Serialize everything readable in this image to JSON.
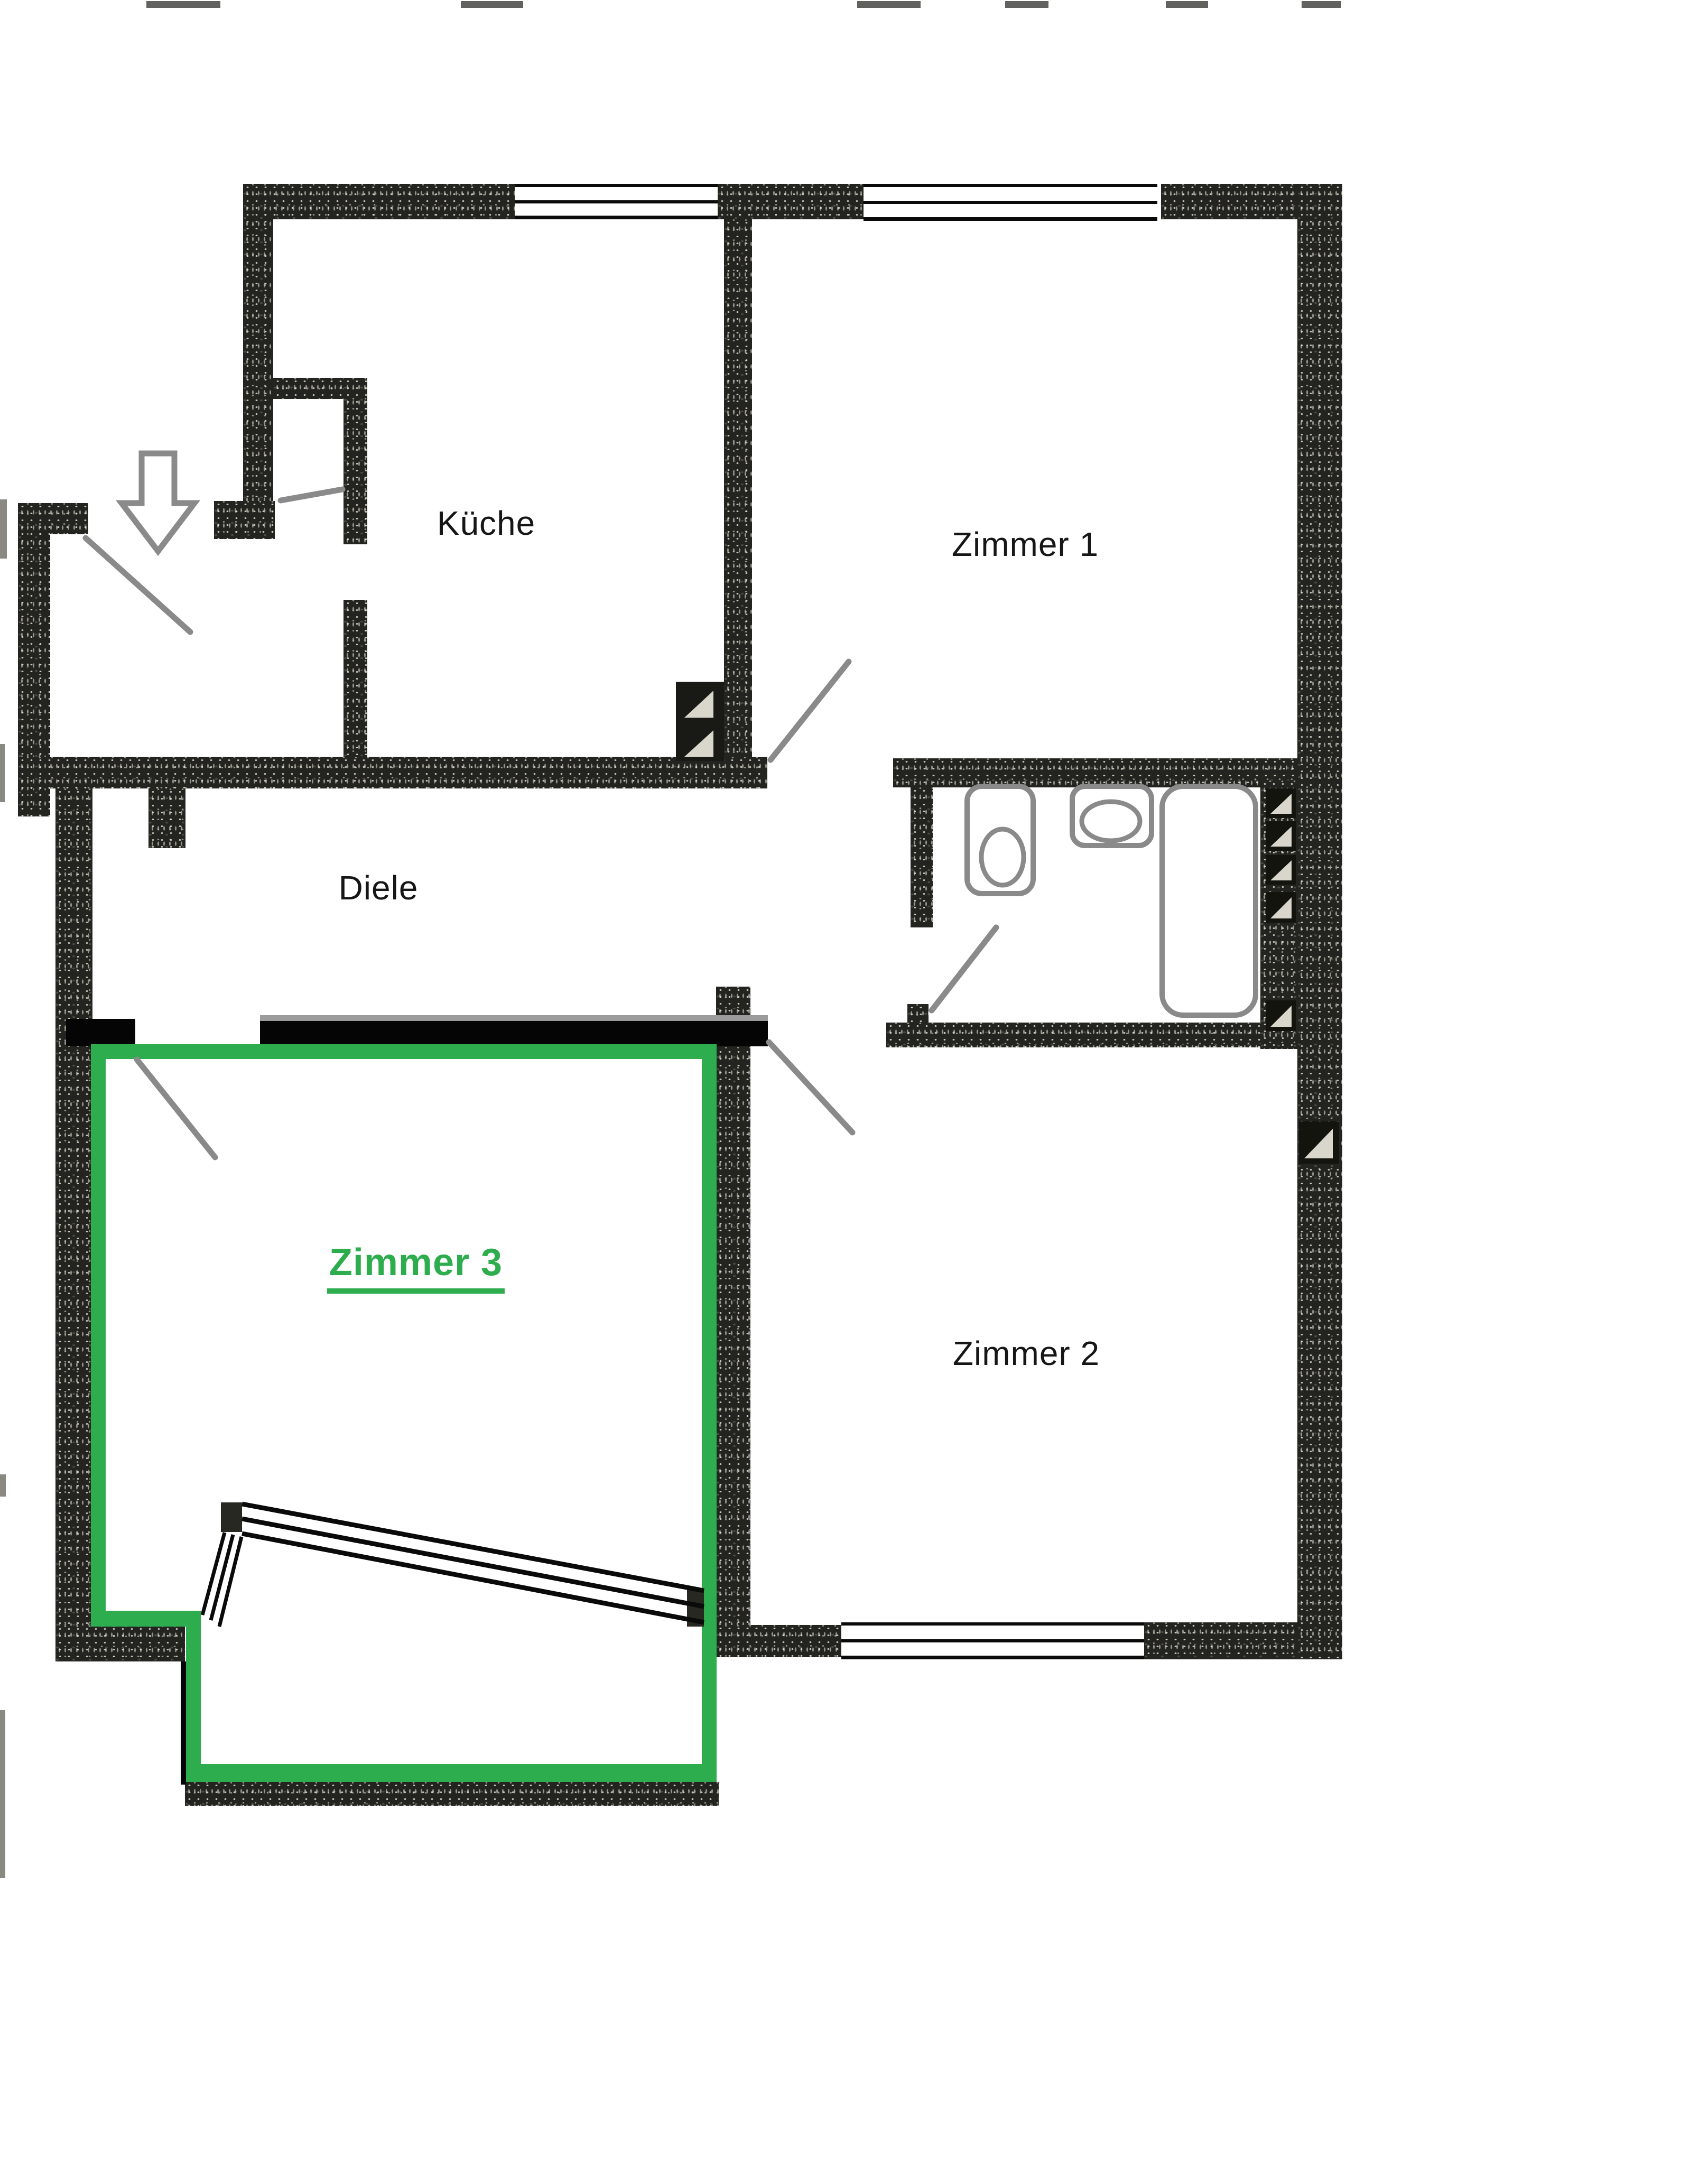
{
  "document": {
    "type": "apartment floor plan (scanned)",
    "background": "#ffffff"
  },
  "rooms": {
    "kueche": {
      "label": "Küche"
    },
    "zimmer1": {
      "label": "Zimmer 1"
    },
    "diele": {
      "label": "Diele"
    },
    "zimmer2": {
      "label": "Zimmer 2"
    },
    "zimmer3": {
      "label": "Zimmer 3",
      "highlighted": true
    }
  },
  "colors": {
    "highlight_green": "#2ead4e",
    "wall_texture_dark": "#23231f",
    "solid_wall_black": "#050505",
    "annotation_gray": "#8a8a8a",
    "window_line_black": "#0a0a0a"
  },
  "icons": {
    "entrance": "entrance-arrow-icon",
    "doors": "door-swing-line-icon",
    "bath": [
      "toilet-icon",
      "sink-icon",
      "bathtub-icon"
    ],
    "shafts": "hatched-shaft-icon",
    "window": "window-frame-icon",
    "tilted_window": "slanted-window-icon"
  }
}
